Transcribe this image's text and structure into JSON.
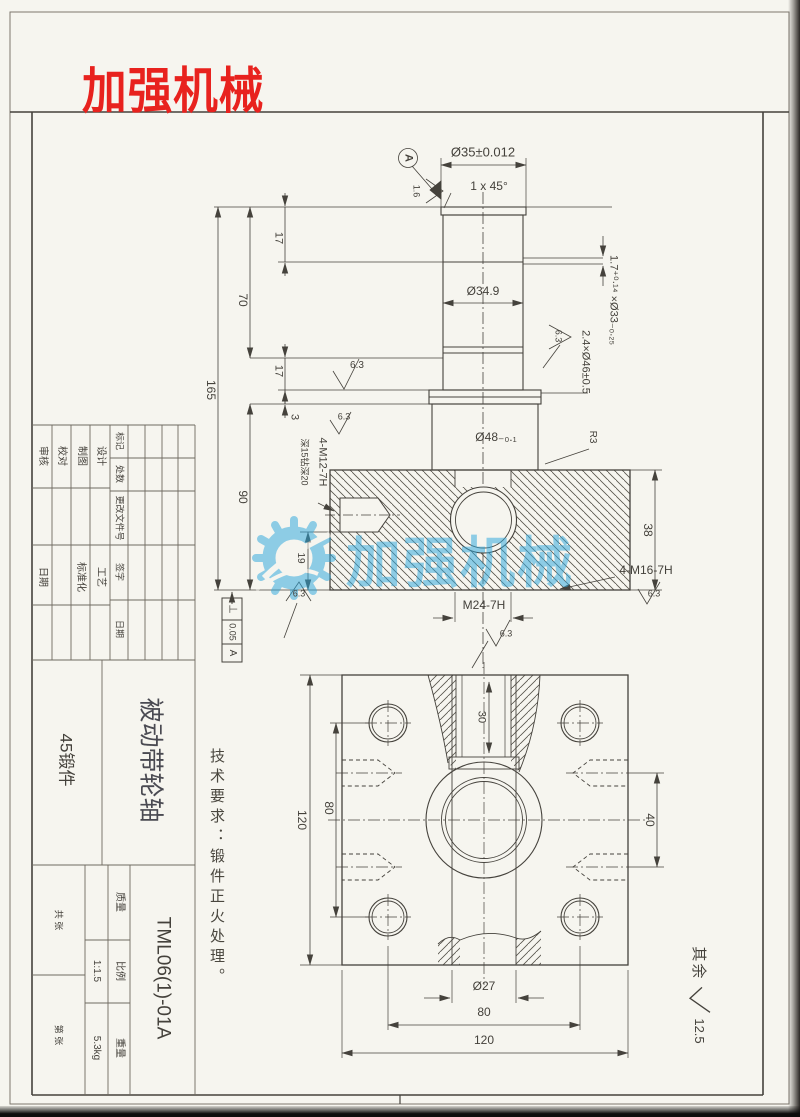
{
  "brand": {
    "logo_text": "加强机械"
  },
  "watermark": {
    "text": "加强机械",
    "color": "#2fa8dc"
  },
  "tech_requirements": "技术要求：锻件正火处理。",
  "frame": {
    "default_roughness_prefix": "其余",
    "default_roughness_value": "12.5"
  },
  "shaft_view": {
    "datum": "A",
    "roughness_datum_face": "1.6",
    "roughness": "6.3",
    "dia_top": "Ø35±0.012",
    "chamfer": "1 x 45°",
    "dia_mid": "Ø34.9",
    "groove_top": "1.7⁺⁰·¹⁴ ×Ø33₋₀.₂₅",
    "groove_flange": "2.4×Ø46±0.5",
    "dia_flange": "Ø48₋₀.₁",
    "fillet": "R3",
    "len_total": "165",
    "len_upper": "70",
    "len_17_top": "17",
    "len_17_low": "17",
    "len_3": "3",
    "len_block": "90",
    "len_pocket": "19",
    "len_right": "38",
    "thread_side": "4-M12-7H",
    "thread_side_note": "深15钻深20",
    "thread_bottom": "4-M16-7H",
    "thread_center": "M24-7H",
    "fcf": {
      "symbol": "⊥",
      "tol": "0.05",
      "datum": "A"
    }
  },
  "flange_view": {
    "width_left": "120",
    "bolt_spacing_left": "80",
    "side_spacing": "40",
    "thread_depth": "30",
    "bore": "Ø27",
    "bolt_spacing_bottom": "80",
    "width_bottom": "120"
  },
  "title_block": {
    "roles_top": [
      "审核",
      "校对",
      "制图",
      "设计"
    ],
    "roles_bottom": [
      "日期",
      "标准化",
      "工艺"
    ],
    "rev_labels": [
      "标记",
      "处数",
      "更改文件号",
      "签字",
      "日期"
    ],
    "part_name": "被动带轮轴",
    "material": "45锻件",
    "drawing_no": "TML06(1)-01A",
    "mass_label": "质量",
    "scale_label": "比例",
    "scale_value": "1:1.5",
    "weight_label": "重量",
    "weight_value": "5.3kg",
    "sheet_total": "共 张",
    "sheet_no": "第 张"
  }
}
